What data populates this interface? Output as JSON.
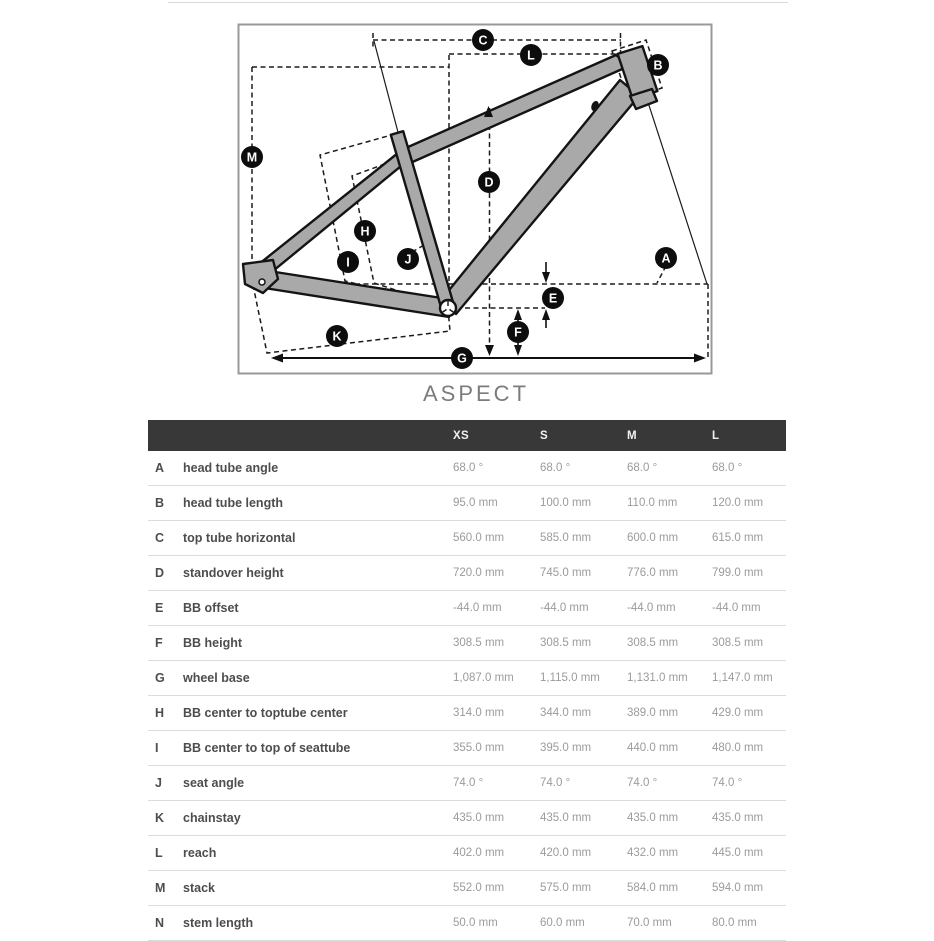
{
  "page": {
    "title": "ASPECT"
  },
  "colors": {
    "frame_fill": "#a9a9a9",
    "frame_outline": "#141414",
    "diagram_border": "#999999",
    "badge_bg": "#0d0d0d",
    "badge_text": "#ffffff",
    "table_header_bg": "#383838",
    "table_header_text": "#f2f2f2",
    "row_label_text": "#4d4d4d",
    "row_value_text": "#9b9b9b",
    "row_border": "#dcdcdc"
  },
  "diagram": {
    "badges": [
      {
        "id": "C",
        "x": 483,
        "y": 40
      },
      {
        "id": "L",
        "x": 531,
        "y": 55
      },
      {
        "id": "B",
        "x": 658,
        "y": 65
      },
      {
        "id": "M",
        "x": 252,
        "y": 157
      },
      {
        "id": "D",
        "x": 489,
        "y": 182
      },
      {
        "id": "H",
        "x": 365,
        "y": 231
      },
      {
        "id": "I",
        "x": 348,
        "y": 262
      },
      {
        "id": "J",
        "x": 408,
        "y": 259
      },
      {
        "id": "A",
        "x": 666,
        "y": 258
      },
      {
        "id": "E",
        "x": 553,
        "y": 298
      },
      {
        "id": "F",
        "x": 518,
        "y": 332
      },
      {
        "id": "K",
        "x": 337,
        "y": 336
      },
      {
        "id": "G",
        "x": 462,
        "y": 358
      }
    ]
  },
  "table": {
    "columns": [
      "XS",
      "S",
      "M",
      "L"
    ],
    "rows": [
      {
        "key": "A",
        "label": "head tube angle",
        "values": [
          "68.0 °",
          "68.0 °",
          "68.0 °",
          "68.0 °"
        ]
      },
      {
        "key": "B",
        "label": "head tube length",
        "values": [
          "95.0 mm",
          "100.0 mm",
          "110.0 mm",
          "120.0 mm"
        ]
      },
      {
        "key": "C",
        "label": "top tube horizontal",
        "values": [
          "560.0 mm",
          "585.0 mm",
          "600.0 mm",
          "615.0 mm"
        ]
      },
      {
        "key": "D",
        "label": "standover height",
        "values": [
          "720.0 mm",
          "745.0 mm",
          "776.0 mm",
          "799.0 mm"
        ]
      },
      {
        "key": "E",
        "label": "BB offset",
        "values": [
          "-44.0 mm",
          "-44.0 mm",
          "-44.0 mm",
          "-44.0 mm"
        ]
      },
      {
        "key": "F",
        "label": "BB height",
        "values": [
          "308.5 mm",
          "308.5 mm",
          "308.5 mm",
          "308.5 mm"
        ]
      },
      {
        "key": "G",
        "label": "wheel base",
        "values": [
          "1,087.0 mm",
          "1,115.0 mm",
          "1,131.0 mm",
          "1,147.0 mm"
        ]
      },
      {
        "key": "H",
        "label": "BB center to toptube center",
        "values": [
          "314.0 mm",
          "344.0 mm",
          "389.0 mm",
          "429.0 mm"
        ]
      },
      {
        "key": "I",
        "label": "BB center to top of seattube",
        "values": [
          "355.0 mm",
          "395.0 mm",
          "440.0 mm",
          "480.0 mm"
        ]
      },
      {
        "key": "J",
        "label": "seat angle",
        "values": [
          "74.0 °",
          "74.0 °",
          "74.0 °",
          "74.0 °"
        ]
      },
      {
        "key": "K",
        "label": "chainstay",
        "values": [
          "435.0 mm",
          "435.0 mm",
          "435.0 mm",
          "435.0 mm"
        ]
      },
      {
        "key": "L",
        "label": "reach",
        "values": [
          "402.0 mm",
          "420.0 mm",
          "432.0 mm",
          "445.0 mm"
        ]
      },
      {
        "key": "M",
        "label": "stack",
        "values": [
          "552.0 mm",
          "575.0 mm",
          "584.0 mm",
          "594.0 mm"
        ]
      },
      {
        "key": "N",
        "label": "stem length",
        "values": [
          "50.0 mm",
          "60.0 mm",
          "70.0 mm",
          "80.0 mm"
        ]
      }
    ]
  }
}
